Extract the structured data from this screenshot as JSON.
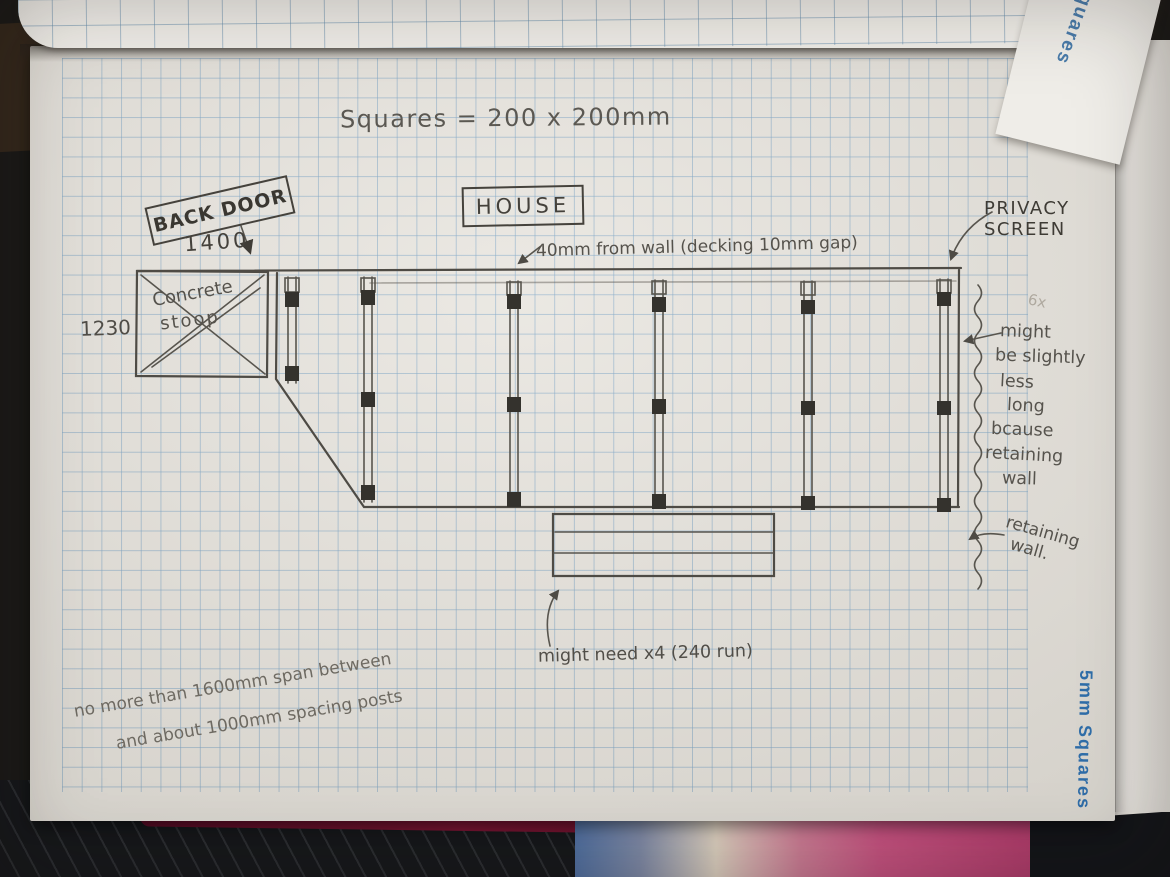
{
  "sketch": {
    "scale_note": "Squares = 200 x 200mm",
    "back_door_label": "BACK DOOR",
    "back_door_width": "1400",
    "house_label": "HOUSE",
    "wall_gap_note": "40mm from wall (decking 10mm gap)",
    "privacy_screen_line1": "PRIVACY",
    "privacy_screen_line2": "SCREEN",
    "stoop_line1": "Concrete",
    "stoop_line2": "stoop",
    "stoop_depth": "1230",
    "faint_mark": "6x",
    "steps_note": "might need x4 (240 run)"
  },
  "right_note": [
    "might",
    "be slightly",
    "less",
    "long",
    "bcause",
    "retaining",
    "wall"
  ],
  "retaining_note": [
    "retaining",
    "wall."
  ],
  "bottom_note": [
    "no more than 1600mm span between",
    "and about 1000mm spacing posts"
  ],
  "printed": {
    "margin_label": "5mm Squares",
    "curled_page_label": "Squares"
  },
  "colors": {
    "paper": "#e9e6e0",
    "grid_blue": "#7da5c6",
    "pencil": "#4e4b45",
    "print_blue": "#2f6da8",
    "cover_red": "#7c1634",
    "pink_paper": "#c2517e"
  }
}
